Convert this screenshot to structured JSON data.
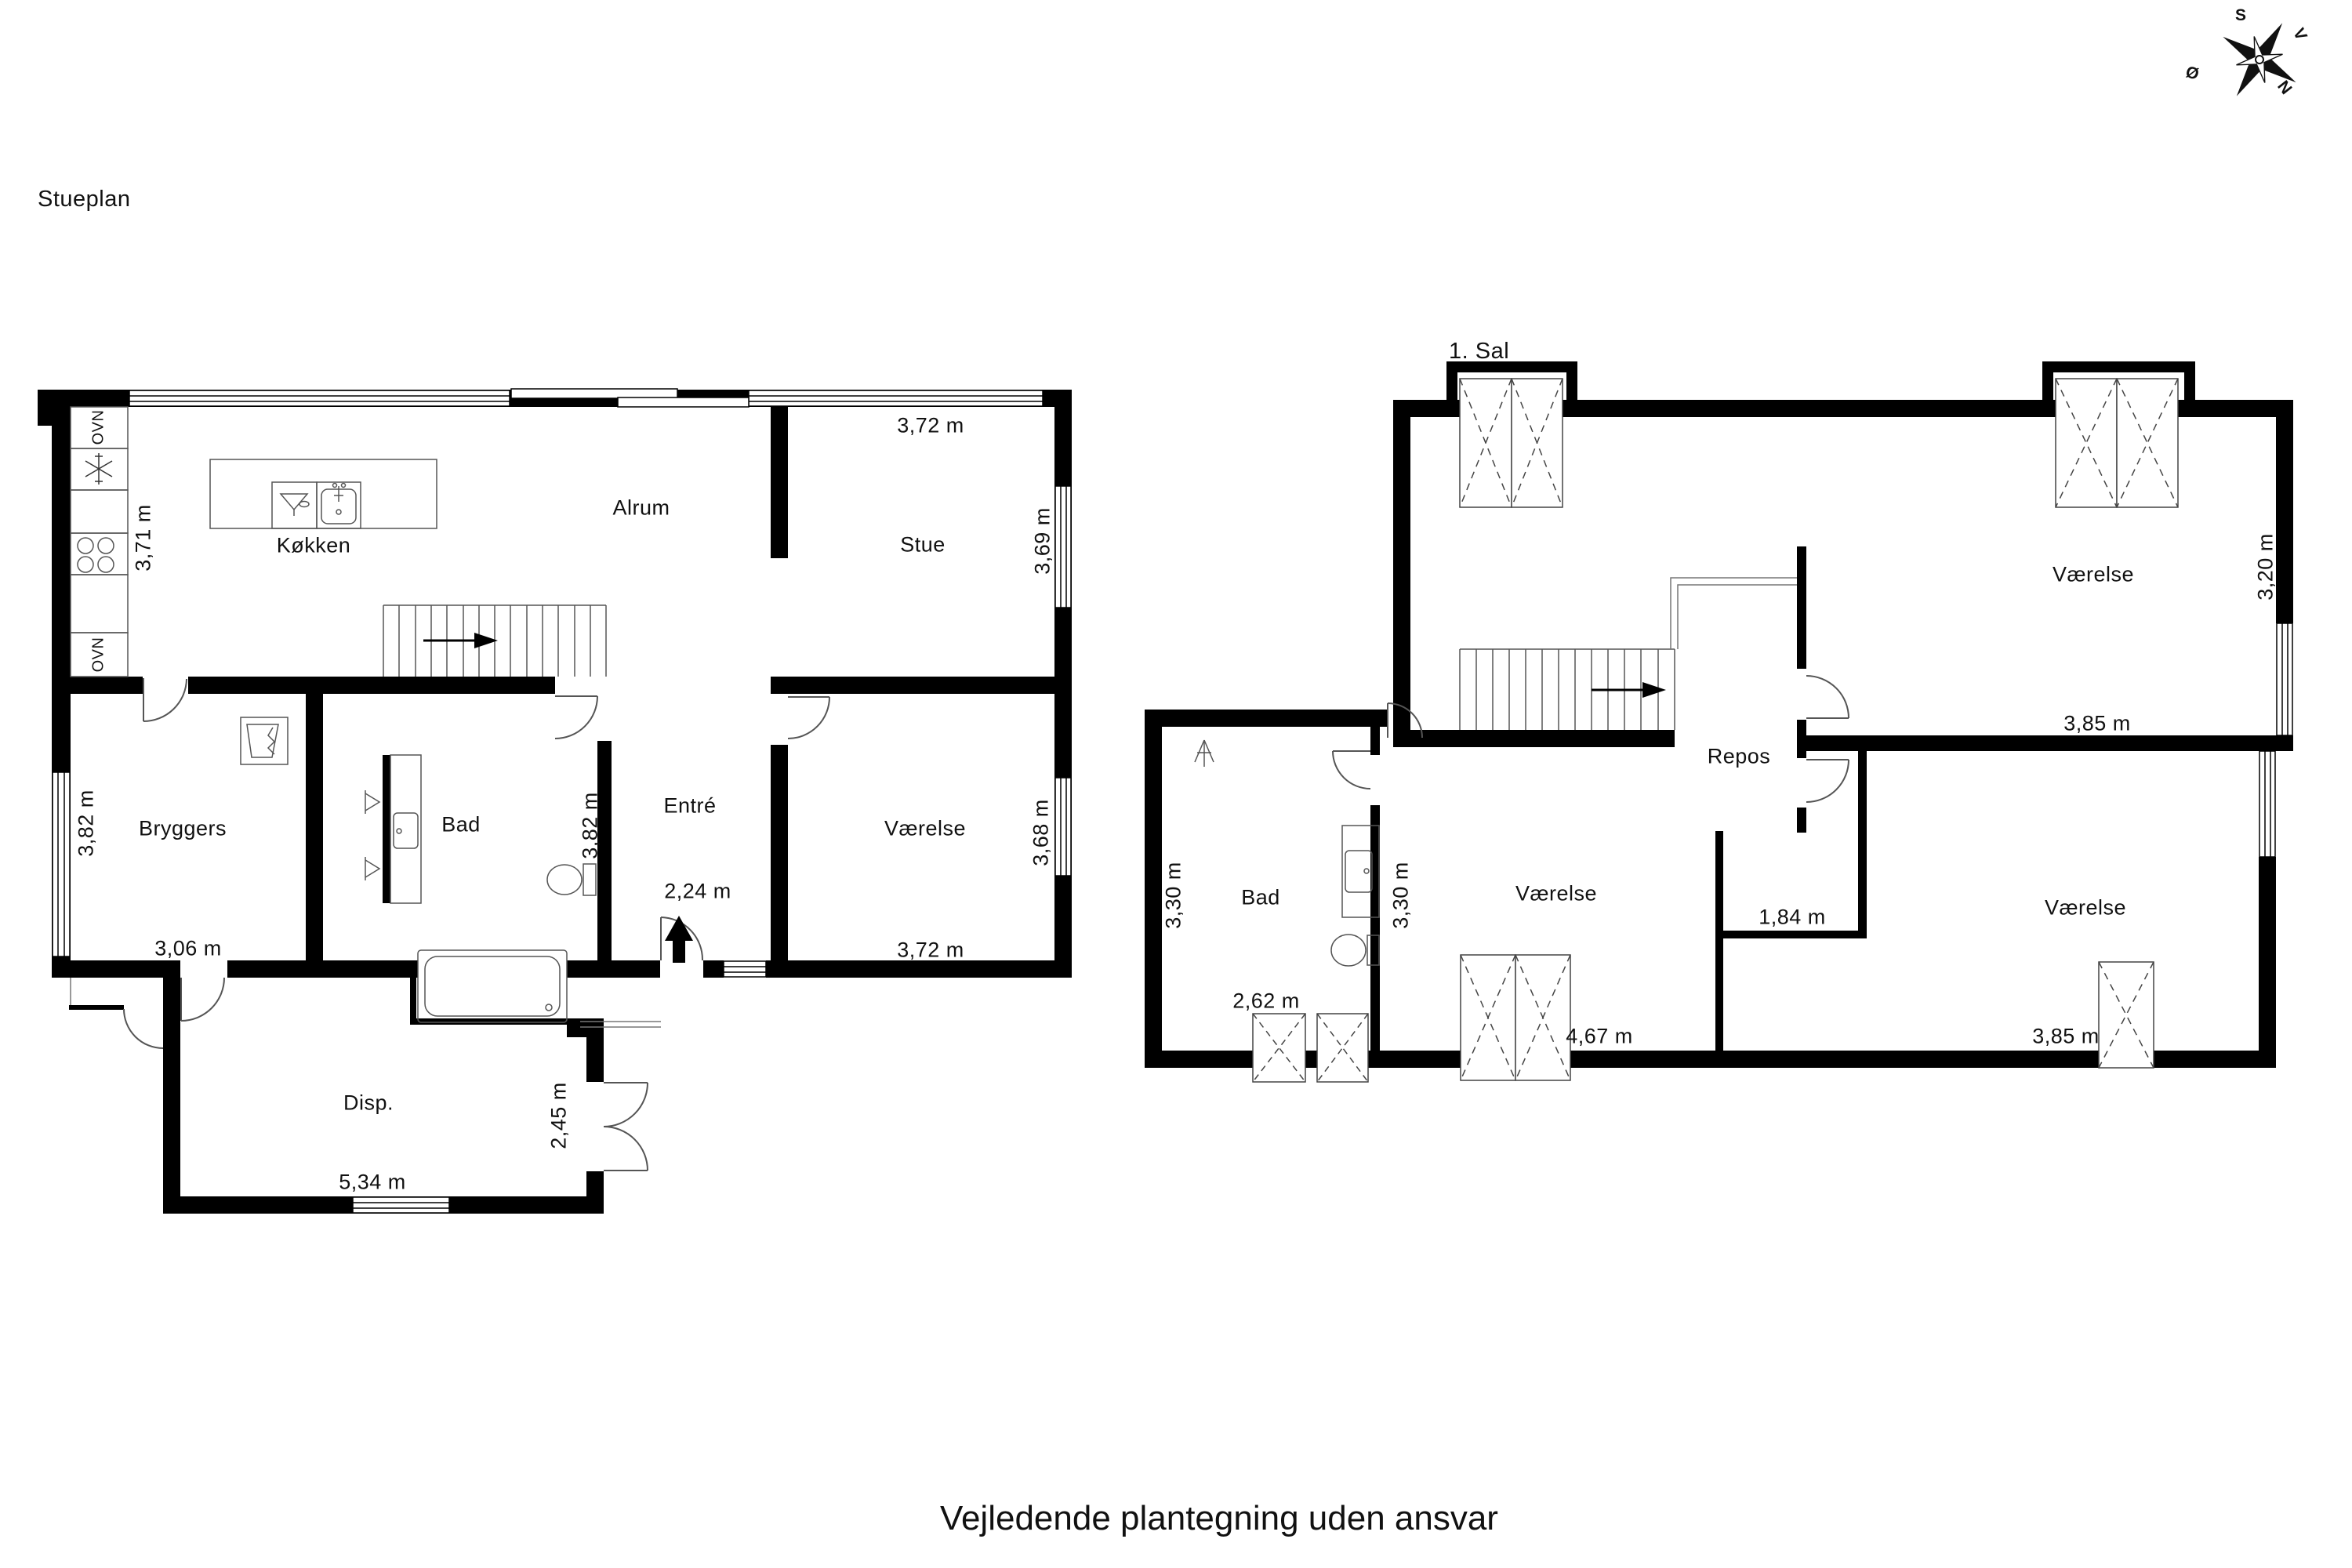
{
  "caption": "Vejledende plantegning uden ansvar",
  "plans": {
    "ground": {
      "title": "Stueplan"
    },
    "first": {
      "title": "1. Sal"
    }
  },
  "labels": {
    "kokken": "Køkken",
    "alrum": "Alrum",
    "stue": "Stue",
    "bryggers": "Bryggers",
    "bad1": "Bad",
    "entre": "Entré",
    "vaerelse1": "Værelse",
    "disp": "Disp.",
    "repos": "Repos",
    "bad2": "Bad",
    "vaerelse2": "Værelse",
    "vaerelse3": "Værelse",
    "vaerelse4": "Værelse",
    "ovn_top": "OVN",
    "ovn_bottom": "OVN"
  },
  "dims": {
    "d371": "3,71 m",
    "d372a": "3,72 m",
    "d369": "3,69 m",
    "d382a": "3,82 m",
    "d382b": "3,82 m",
    "d368": "3,68 m",
    "d372b": "3,72 m",
    "d306": "3,06 m",
    "d224": "2,24 m",
    "d534": "5,34 m",
    "d245": "2,45 m",
    "d330a": "3,30 m",
    "d330b": "3,30 m",
    "d262": "2,62 m",
    "d467": "4,67 m",
    "d184": "1,84 m",
    "d320": "3,20 m",
    "d385a": "3,85 m",
    "d385b": "3,85 m"
  },
  "compass": {
    "s": "S",
    "v": "V",
    "n": "N",
    "o": "Ø"
  },
  "colors": {
    "wall": "#000000",
    "fixture": "#555555",
    "thin": "#777777",
    "text": "#111111"
  }
}
